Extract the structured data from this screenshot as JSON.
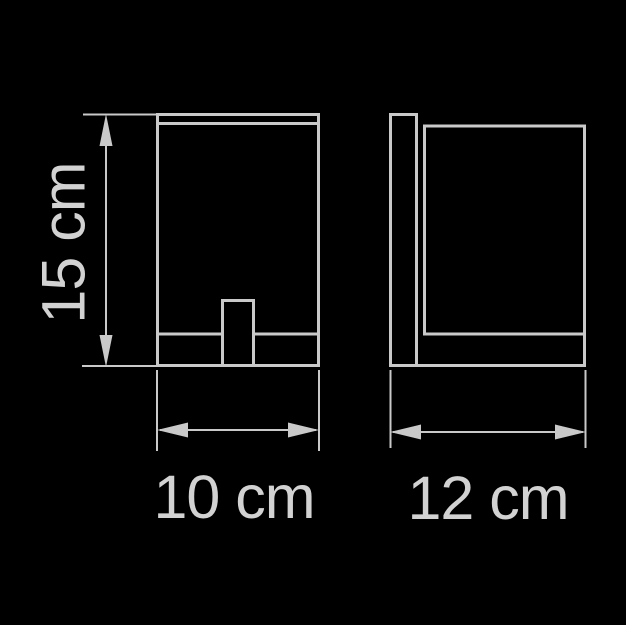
{
  "diagram": {
    "background_color": "#000000",
    "line_color": "#c9c9c9",
    "text_color": "#d2d2d2",
    "description_labels": {
      "height_label": "15 cm",
      "width_label": "10 cm",
      "depth_label": "12 cm"
    },
    "dimensions": {
      "height": {
        "label": "15 cm",
        "value": 15,
        "unit": "cm",
        "orientation": "vertical"
      },
      "width": {
        "label": "10 cm",
        "value": 10,
        "unit": "cm",
        "orientation": "horizontal"
      },
      "depth": {
        "label": "12 cm",
        "value": 12,
        "unit": "cm",
        "orientation": "horizontal"
      }
    }
  }
}
